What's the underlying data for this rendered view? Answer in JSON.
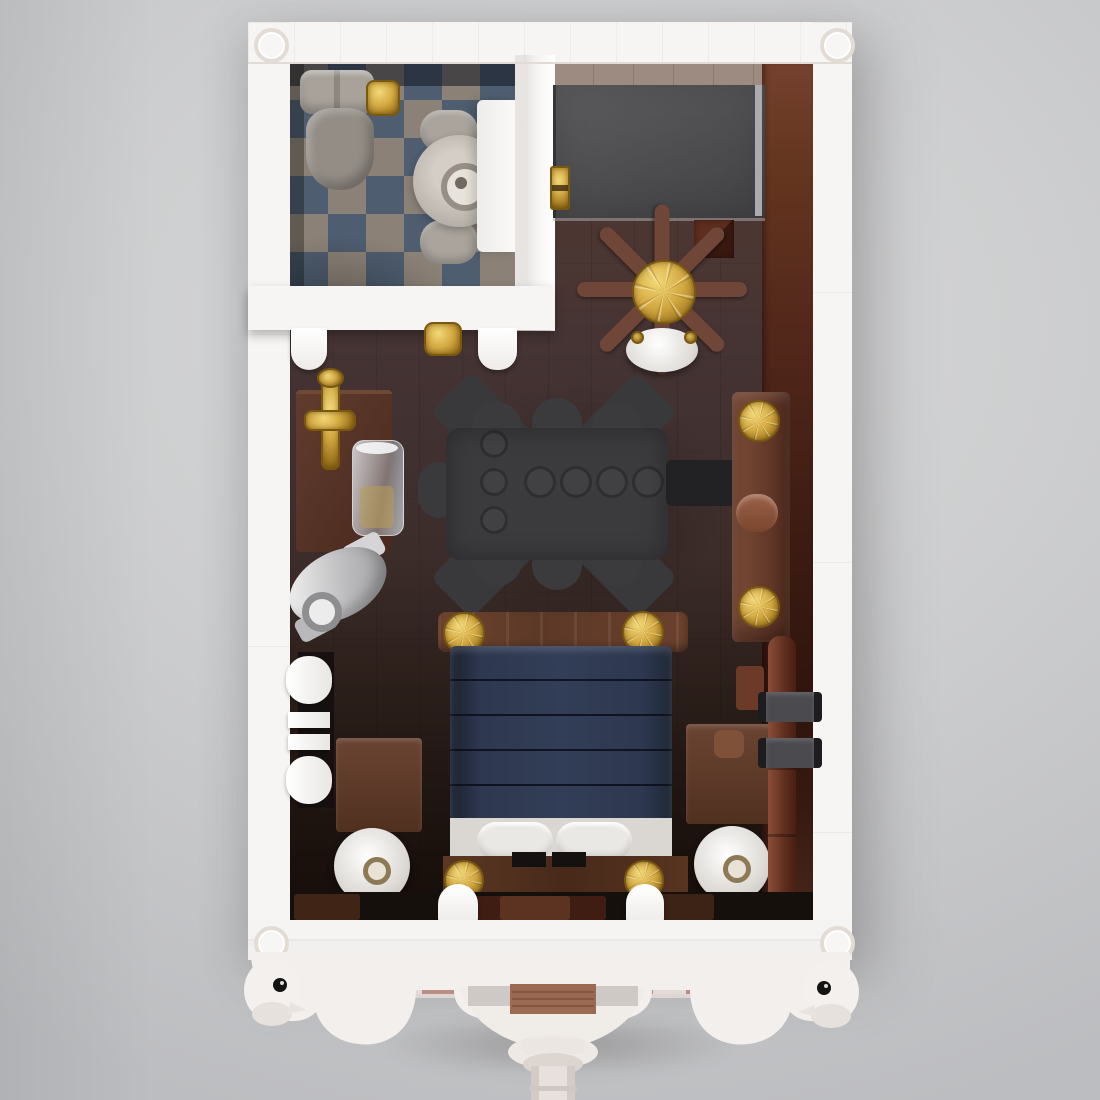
{
  "scene": {
    "description": "Top-down 3D render of a LEGO-style miniature apartment interior with bathroom, bedroom furniture and an ornate balcony ledge",
    "rooms": {
      "bathroom": {
        "floor": "blue and taupe checkered tiles",
        "items": [
          "toilet-with-tank",
          "gold-flush-lever",
          "round-basin",
          "white-vanity",
          "towel-rolls",
          "gold-door-knob",
          "door-pilasters"
        ]
      },
      "bedroom": {
        "floor": "dark brown wood planks",
        "items": [
          "gray-wardrobe-panel",
          "gold-hinge",
          "brown-spoke-clock",
          "white-ceiling-lamp",
          "black-rug-piano-shape",
          "black-bench",
          "brown-dresser-gold-knobs",
          "side-table",
          "gold-candlestick",
          "glass-jar",
          "silver-horn",
          "white-radiator",
          "left-nightstand",
          "right-nightstand",
          "round-table-lamps",
          "brown-wall-pipe-with-clamps",
          "bed-navy-blanket",
          "white-pillows",
          "gold-bedposts",
          "dark-wood-pyramid-tile"
        ]
      },
      "balcony": {
        "floor": "pink and white checkered tiles",
        "items": [
          "stair-opening",
          "wood-step",
          "scalloped-white-trim",
          "bird-finial-left",
          "bird-finial-right",
          "white-pedestal"
        ]
      }
    },
    "walls": "white brick walls with corner studs"
  },
  "palette": {
    "background_top": "#d8d9da",
    "background_bottom": "#bcbdc0",
    "wall_white": "#f7f5f3",
    "tile_blue": "#4e5d6f",
    "tile_taupe": "#8b8177",
    "panel_gray": "#4d4d4f",
    "rug_black": "#3b3b3e",
    "gold": "#cda43e",
    "furniture_brown": "#6a4030",
    "bed_navy": "#2c3549",
    "sheet_white": "#dad7d2",
    "pipe_brown": "#74402c",
    "floor_black": "#16100d",
    "balcony_deck": "#ded6d3",
    "balcony_tile_pink": "#bb8e84",
    "scallop_white": "#f2efec",
    "step_wood": "#9b6a52"
  }
}
